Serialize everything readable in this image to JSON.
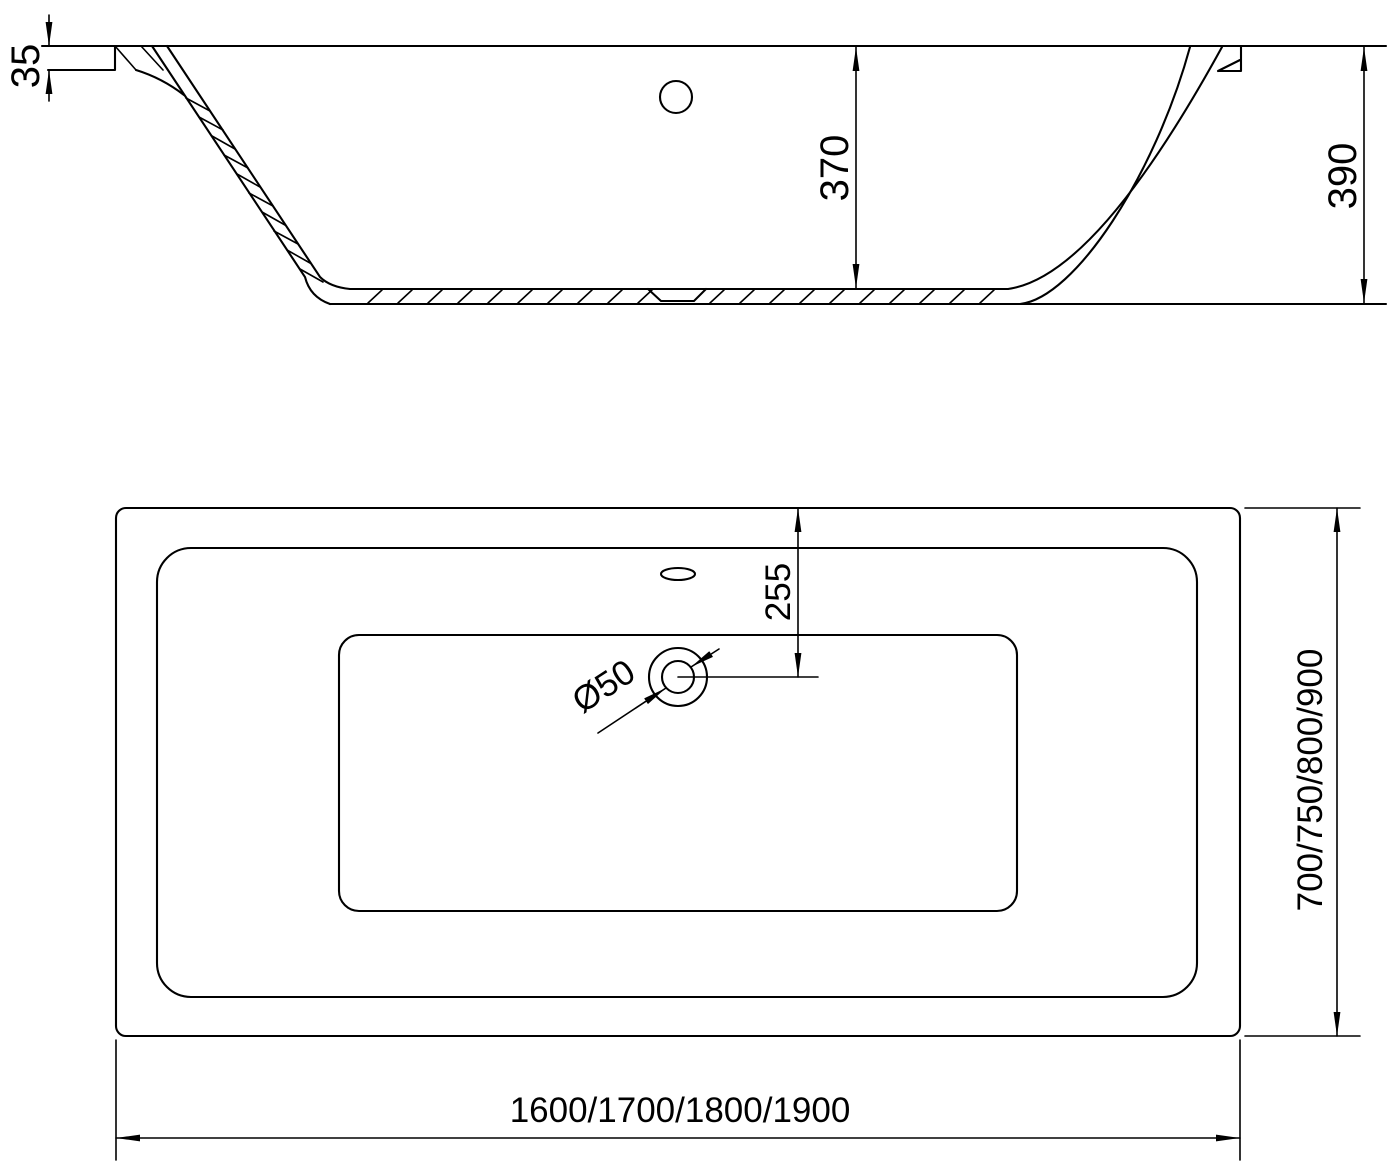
{
  "page": {
    "background_color": "#ffffff",
    "line_color": "#000000",
    "description": "Technical dimension drawing of a rectangular bathtub: side cross-section view (top) and plan view (bottom)"
  },
  "section_view": {
    "label": "bathtub-cross-section",
    "dims": {
      "rim_thickness": "35",
      "inner_depth": "370",
      "overall_height": "390"
    }
  },
  "plan_view": {
    "label": "bathtub-plan-view",
    "dims": {
      "drain_offset": "255",
      "drain_diameter": "Ø50",
      "width_options": "700/750/800/900",
      "length_options": "1600/1700/1800/1900"
    }
  }
}
